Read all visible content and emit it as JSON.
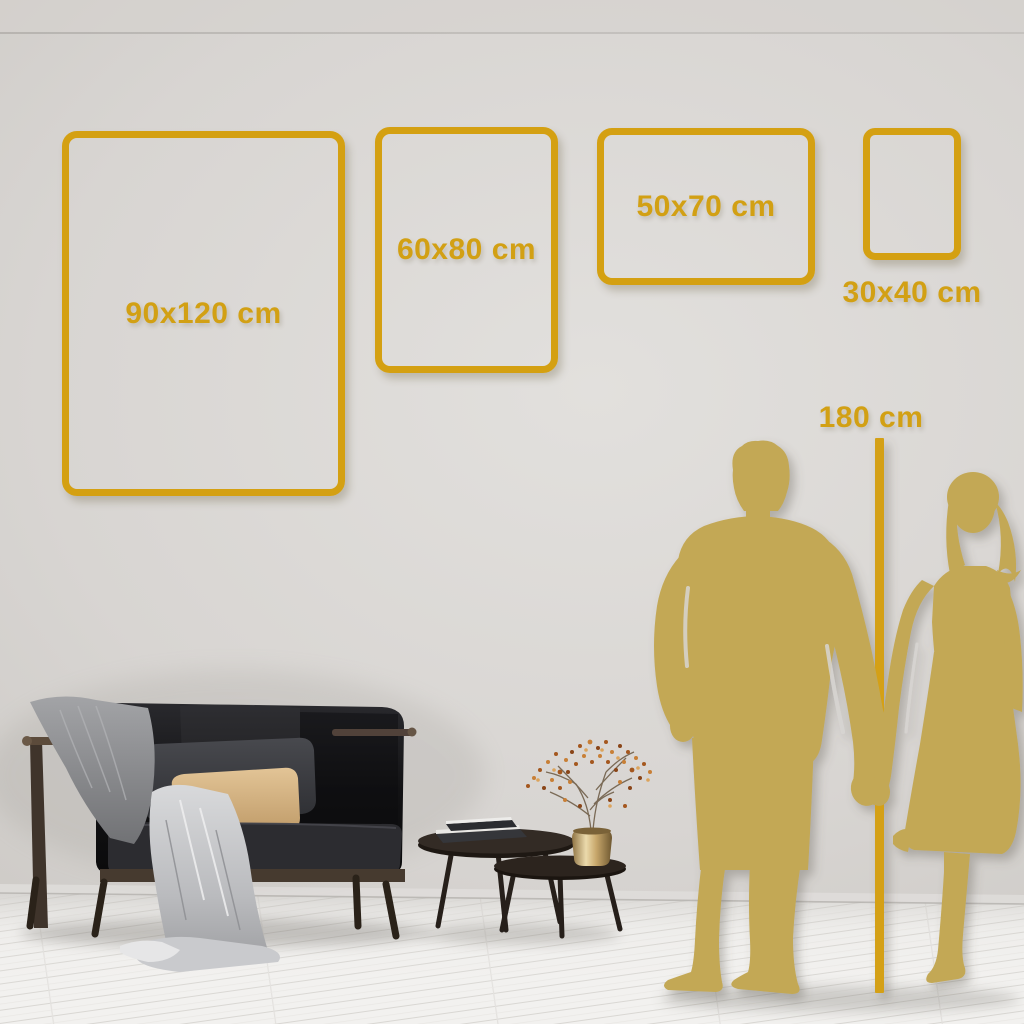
{
  "colors": {
    "accent_gold": "#D4A012",
    "silhouette_gold": "#C3A855",
    "wall_light": "#E2E0DD",
    "wall_dark": "#C1BEBA",
    "floor": "#F2F1EF"
  },
  "size_frames": [
    {
      "id": "90x120",
      "label": "90x120 cm",
      "width_cm": 90,
      "height_cm": 120,
      "orientation": "portrait",
      "label_position": "inside"
    },
    {
      "id": "60x80",
      "label": "60x80 cm",
      "width_cm": 60,
      "height_cm": 80,
      "orientation": "portrait",
      "label_position": "inside"
    },
    {
      "id": "50x70",
      "label": "50x70 cm",
      "width_cm": 50,
      "height_cm": 70,
      "orientation": "landscape",
      "label_position": "inside"
    },
    {
      "id": "30x40",
      "label": "30x40 cm",
      "width_cm": 30,
      "height_cm": 40,
      "orientation": "portrait",
      "label_position": "below"
    }
  ],
  "height_reference": {
    "label": "180 cm",
    "value_cm": 180
  }
}
